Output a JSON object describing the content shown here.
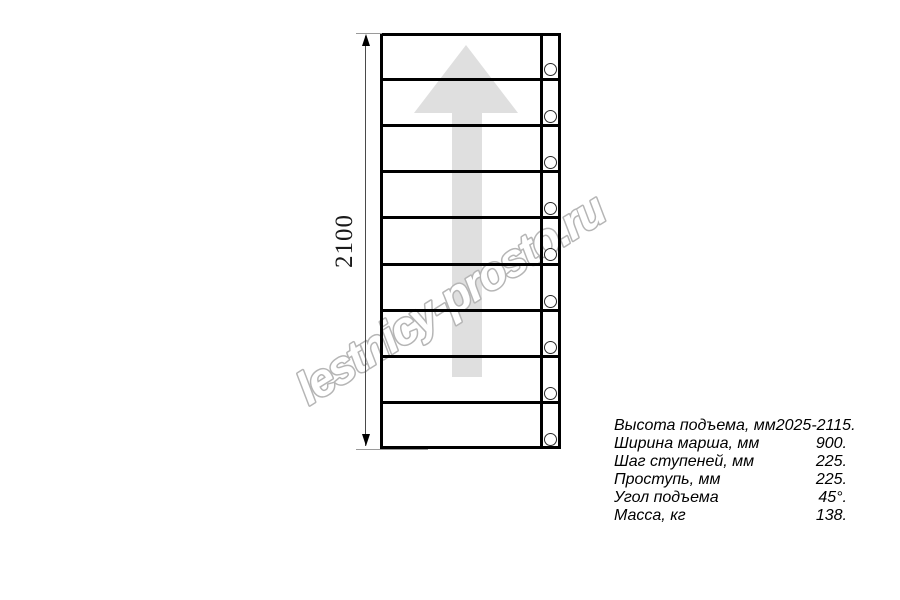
{
  "watermark": {
    "text": "lestnicy-prosto.ru",
    "stroke_color": "#b5b5b5"
  },
  "drawing": {
    "dimension_label": "2100",
    "steps_count": 9,
    "holes_count": 9,
    "arrow_color": "#dfdfdf",
    "line_color": "#000000"
  },
  "specs": {
    "rows": [
      {
        "label": "Высота подъема, мм",
        "value": "2025-2115."
      },
      {
        "label": "Ширина марша, мм",
        "value": "900."
      },
      {
        "label": "Шаг ступеней, мм",
        "value": "225."
      },
      {
        "label": "Проступь, мм",
        "value": "225."
      },
      {
        "label": "Угол подъема",
        "value": "45°."
      },
      {
        "label": "Масса, кг",
        "value": "138."
      }
    ]
  }
}
